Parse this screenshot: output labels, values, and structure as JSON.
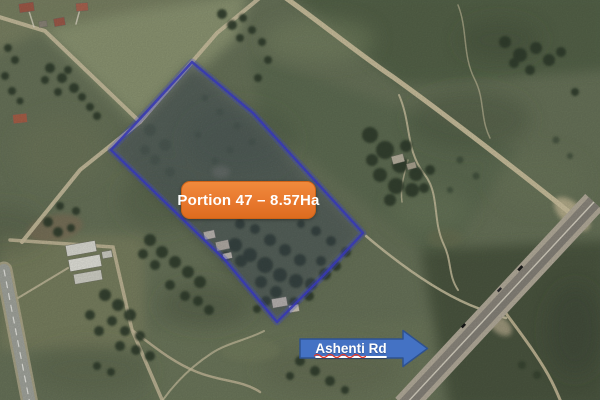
{
  "annotations": {
    "parcel_label": "Portion 47 – 8.57Ha",
    "road_label": "Ashenti Rd"
  },
  "colors": {
    "parcel_label_bg": "#E8782E",
    "parcel_label_text": "#FFFFFF",
    "parcel_boundary": "#3F41C7",
    "road_arrow_fill": "#4472C4",
    "road_arrow_border": "#2F528F",
    "road_arrow_text": "#FFFFFF",
    "spellcheck_squiggle": "#E23B2E"
  }
}
